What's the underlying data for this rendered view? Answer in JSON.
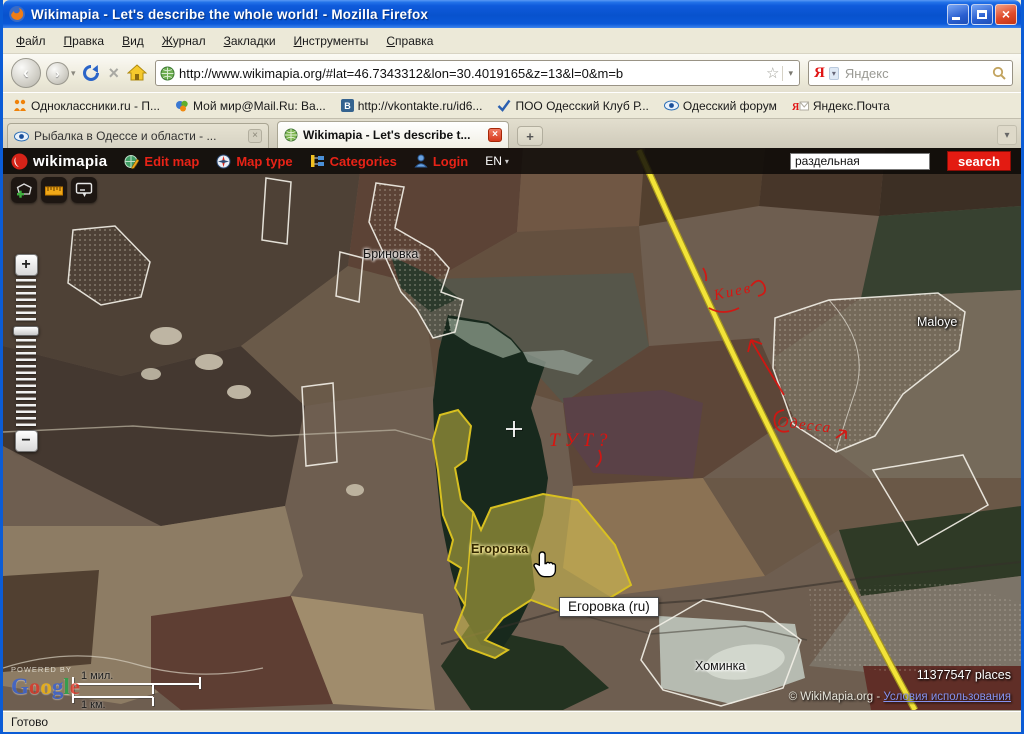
{
  "window": {
    "title": "Wikimapia - Let's describe the whole world! - Mozilla Firefox"
  },
  "icons": {
    "close": "×",
    "star": "☆",
    "caret": "▾",
    "back": "‹",
    "forward": "›",
    "stop": "×",
    "new_tab": "+",
    "zoom_in": "+",
    "zoom_out": "−",
    "tab_close": "×",
    "overflow": "▾",
    "yandex_initial": "Я",
    "yamail_initial": "Я"
  },
  "menu": {
    "items": [
      "Файл",
      "Правка",
      "Вид",
      "Журнал",
      "Закладки",
      "Инструменты",
      "Справка"
    ]
  },
  "navigation": {
    "url": "http://www.wikimapia.org/#lat=46.7343312&lon=30.4019165&z=13&l=0&m=b",
    "yandex_placeholder": "Яндекс"
  },
  "bookmarks": {
    "items": [
      "Одноклассники.ru - П...",
      "Мой мир@Mail.Ru: Ва...",
      "http://vkontakte.ru/id6...",
      "ПОО Одесский Клуб Р...",
      "Одесский форум",
      "Яндекс.Почта"
    ]
  },
  "tabs": {
    "inactive": "Рыбалка в Одессе и области - ...",
    "active": "Wikimapia - Let's describe t..."
  },
  "wikimapia": {
    "logo": "wikimapia",
    "edit_map": "Edit map",
    "map_type": "Map type",
    "categories": "Categories",
    "login": "Login",
    "lang": "EN",
    "search_value": "раздельная",
    "search_button": "search"
  },
  "map": {
    "labels": {
      "brinovka": "Бриновка",
      "maloye": "Maloye",
      "egorovka": "Егоровка",
      "khominka": "Хоминка"
    },
    "tooltip": "Егоровка (ru)",
    "annotations": {
      "top": "Киев",
      "center": "ТУТ?",
      "bottom": "Одесса"
    },
    "scale": {
      "miles": "1 мил.",
      "km": "1 км."
    },
    "attribution": {
      "powered_by": "POWERED BY",
      "google": [
        "G",
        "o",
        "o",
        "g",
        "l",
        "e"
      ],
      "places": "11377547 places",
      "copyright": "© WikiMapia.org - ",
      "terms": "Условия использования"
    }
  },
  "statusbar": {
    "text": "Готово"
  }
}
